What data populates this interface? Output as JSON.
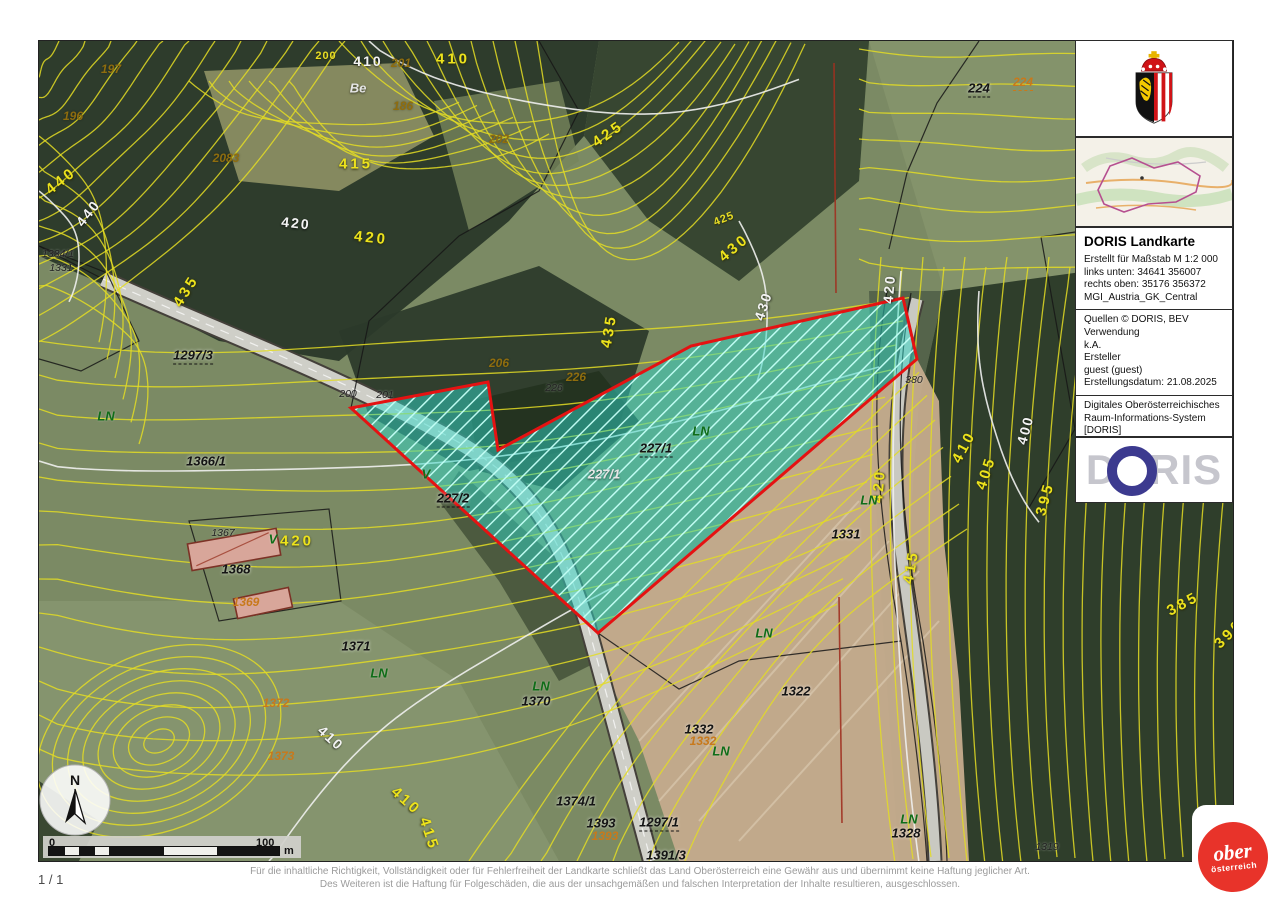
{
  "page": {
    "page_indicator": "1 / 1",
    "disclaimer_line1": "Für die inhaltliche Richtigkeit, Vollständigkeit oder für Fehlerfreiheit der Landkarte schließt das Land Oberösterreich eine Gewähr aus und übernimmt keine Haftung jeglicher Art.",
    "disclaimer_line2": "Des Weiteren ist die Haftung für Folgeschäden, die aus der unsachgemäßen und falschen Interpretation der Inhalte resultieren, ausgeschlossen."
  },
  "sidebar": {
    "title": "DORIS Landkarte",
    "meta": [
      "Erstellt für Maßstab M 1:2 000",
      "links unten: 34641 356007",
      "rechts oben: 35176 356372",
      "MGI_Austria_GK_Central"
    ],
    "source": [
      "Quellen © DORIS, BEV",
      "Verwendung",
      "k.A.",
      "Ersteller",
      "guest (guest)",
      "Erstellungsdatum: 21.08.2025"
    ],
    "contact": [
      "Digitales Oberösterreichisches",
      "Raum-Informations-System [DORIS]",
      "A-4021 Linz, Bahnhofplatz 1",
      "+43 732-7720-12541",
      "doris.geol.post@ooe.gv.at",
      "https://doris.ooe.gv.at"
    ],
    "doris_logo": {
      "d": "D",
      "ris": "RIS"
    }
  },
  "branding": {
    "land_logo_line1": "ober",
    "land_logo_line2": "österreich"
  },
  "scalebar": {
    "start": "0",
    "end": "100",
    "unit": "m"
  },
  "north_arrow": {
    "label": "N"
  },
  "colors": {
    "parcel_fill": "#2fd8c8",
    "parcel_border": "#e51212",
    "contour_yellow": "#e3dc25",
    "contour_index_white": "#f0f0ee",
    "field_tan": "#c4ab8c",
    "forest_dark": "#2b392a",
    "crest_red": "#d01317",
    "logo_blue": "#3c3a8f"
  },
  "map": {
    "highlighted_parcel_label": "227/1",
    "labels": [
      {
        "t": "197",
        "x": 72,
        "y": 28,
        "c": "ol"
      },
      {
        "t": "196",
        "x": 34,
        "y": 75,
        "c": "ol"
      },
      {
        "t": "200",
        "x": 287,
        "y": 15,
        "c": "cy2"
      },
      {
        "t": "410",
        "x": 329,
        "y": 20,
        "c": "cw"
      },
      {
        "t": "201",
        "x": 362,
        "y": 22,
        "c": "ol"
      },
      {
        "t": "410",
        "x": 414,
        "y": 18,
        "c": "cy"
      },
      {
        "t": "Be",
        "x": 319,
        "y": 47,
        "c": "cw2"
      },
      {
        "t": "186",
        "x": 364,
        "y": 65,
        "c": "ol"
      },
      {
        "t": "202",
        "x": 460,
        "y": 98,
        "c": "ol"
      },
      {
        "t": "2083",
        "x": 187,
        "y": 117,
        "c": "ol"
      },
      {
        "t": "440",
        "x": 22,
        "y": 140,
        "c": "cy",
        "r": -38
      },
      {
        "t": "440",
        "x": 49,
        "y": 172,
        "c": "cw",
        "r": -52
      },
      {
        "t": "415",
        "x": 317,
        "y": 123,
        "c": "cy"
      },
      {
        "t": "420",
        "x": 257,
        "y": 182,
        "c": "cw",
        "r": 6
      },
      {
        "t": "420",
        "x": 332,
        "y": 197,
        "c": "cy",
        "r": 6
      },
      {
        "t": "435",
        "x": 147,
        "y": 250,
        "c": "cy",
        "r": -58
      },
      {
        "t": "425",
        "x": 569,
        "y": 93,
        "c": "cy",
        "r": -35
      },
      {
        "t": "425",
        "x": 685,
        "y": 178,
        "c": "cy2",
        "r": -22
      },
      {
        "t": "430",
        "x": 695,
        "y": 207,
        "c": "cy",
        "r": -40
      },
      {
        "t": "430",
        "x": 724,
        "y": 265,
        "c": "cw",
        "r": -72
      },
      {
        "t": "435",
        "x": 570,
        "y": 290,
        "c": "cy",
        "r": -80
      },
      {
        "t": "224",
        "x": 940,
        "y": 48,
        "c": "blk dashed"
      },
      {
        "t": "224",
        "x": 984,
        "y": 42,
        "c": "co dashed"
      },
      {
        "t": "206",
        "x": 460,
        "y": 322,
        "c": "ol"
      },
      {
        "t": "226",
        "x": 537,
        "y": 336,
        "c": "ol"
      },
      {
        "t": "226",
        "x": 515,
        "y": 347,
        "c": "blk2"
      },
      {
        "t": "1334/1",
        "x": 19,
        "y": 213,
        "c": "blk2"
      },
      {
        "t": "1331",
        "x": 22,
        "y": 227,
        "c": "blk2"
      },
      {
        "t": "1297/3",
        "x": 154,
        "y": 315,
        "c": "blk dashed"
      },
      {
        "t": "LN",
        "x": 67,
        "y": 375,
        "c": "gr"
      },
      {
        "t": "1366/1",
        "x": 167,
        "y": 420,
        "c": "blk"
      },
      {
        "t": "200",
        "x": 309,
        "y": 353,
        "c": "blk2"
      },
      {
        "t": "201",
        "x": 346,
        "y": 354,
        "c": "blk2"
      },
      {
        "t": "V",
        "x": 387,
        "y": 433,
        "c": "gr"
      },
      {
        "t": "227/2",
        "x": 414,
        "y": 458,
        "c": "blk dashed"
      },
      {
        "t": "1367",
        "x": 184,
        "y": 492,
        "c": "blk2"
      },
      {
        "t": "V",
        "x": 234,
        "y": 498,
        "c": "gr"
      },
      {
        "t": "420",
        "x": 258,
        "y": 500,
        "c": "cy"
      },
      {
        "t": "1368",
        "x": 197,
        "y": 528,
        "c": "blk"
      },
      {
        "t": "1369",
        "x": 207,
        "y": 561,
        "c": "co"
      },
      {
        "t": "1371",
        "x": 317,
        "y": 605,
        "c": "blk"
      },
      {
        "t": "LN",
        "x": 340,
        "y": 632,
        "c": "gr"
      },
      {
        "t": "1372",
        "x": 237,
        "y": 662,
        "c": "co"
      },
      {
        "t": "1373",
        "x": 242,
        "y": 715,
        "c": "co"
      },
      {
        "t": "410",
        "x": 292,
        "y": 697,
        "c": "cw",
        "r": 42
      },
      {
        "t": "410",
        "x": 367,
        "y": 760,
        "c": "cy",
        "r": 42
      },
      {
        "t": "415",
        "x": 390,
        "y": 793,
        "c": "cy",
        "r": 72
      },
      {
        "t": "LN",
        "x": 502,
        "y": 645,
        "c": "gr"
      },
      {
        "t": "1370",
        "x": 497,
        "y": 660,
        "c": "blk"
      },
      {
        "t": "1374/1",
        "x": 537,
        "y": 760,
        "c": "blk"
      },
      {
        "t": "1393",
        "x": 562,
        "y": 782,
        "c": "blk"
      },
      {
        "t": "1393",
        "x": 566,
        "y": 795,
        "c": "co"
      },
      {
        "t": "1297/1",
        "x": 620,
        "y": 782,
        "c": "blk dashed"
      },
      {
        "t": "1391/3",
        "x": 627,
        "y": 815,
        "c": "blk dashed"
      },
      {
        "t": "1332",
        "x": 660,
        "y": 688,
        "c": "blk"
      },
      {
        "t": "1332",
        "x": 664,
        "y": 700,
        "c": "co"
      },
      {
        "t": "LN",
        "x": 682,
        "y": 710,
        "c": "gr"
      },
      {
        "t": "1322",
        "x": 757,
        "y": 650,
        "c": "blk"
      },
      {
        "t": "LN",
        "x": 725,
        "y": 592,
        "c": "gr"
      },
      {
        "t": "1331",
        "x": 807,
        "y": 493,
        "c": "blk"
      },
      {
        "t": "LN",
        "x": 870,
        "y": 778,
        "c": "gr"
      },
      {
        "t": "1328",
        "x": 867,
        "y": 792,
        "c": "blk"
      },
      {
        "t": "LN",
        "x": 662,
        "y": 390,
        "c": "gr"
      },
      {
        "t": "227/1",
        "x": 617,
        "y": 408,
        "c": "blk dashed"
      },
      {
        "t": "227/1",
        "x": 565,
        "y": 433,
        "c": "cw2"
      },
      {
        "t": "420",
        "x": 850,
        "y": 248,
        "c": "cw",
        "r": -85
      },
      {
        "t": "420",
        "x": 840,
        "y": 445,
        "c": "cy",
        "r": -85
      },
      {
        "t": "LN",
        "x": 830,
        "y": 459,
        "c": "gr"
      },
      {
        "t": "380",
        "x": 875,
        "y": 339,
        "c": "blk2"
      },
      {
        "t": "410",
        "x": 925,
        "y": 406,
        "c": "cy",
        "r": -62
      },
      {
        "t": "400",
        "x": 986,
        "y": 389,
        "c": "cw",
        "r": -75
      },
      {
        "t": "405",
        "x": 947,
        "y": 432,
        "c": "cy",
        "r": -72
      },
      {
        "t": "395",
        "x": 1006,
        "y": 458,
        "c": "cy",
        "r": -75
      },
      {
        "t": "415",
        "x": 872,
        "y": 526,
        "c": "cy",
        "r": -80
      },
      {
        "t": "385",
        "x": 1144,
        "y": 563,
        "c": "cy",
        "r": -28
      },
      {
        "t": "390",
        "x": 1190,
        "y": 593,
        "c": "cy",
        "r": -45
      },
      {
        "t": "1319",
        "x": 1008,
        "y": 806,
        "c": "blk2"
      }
    ]
  }
}
